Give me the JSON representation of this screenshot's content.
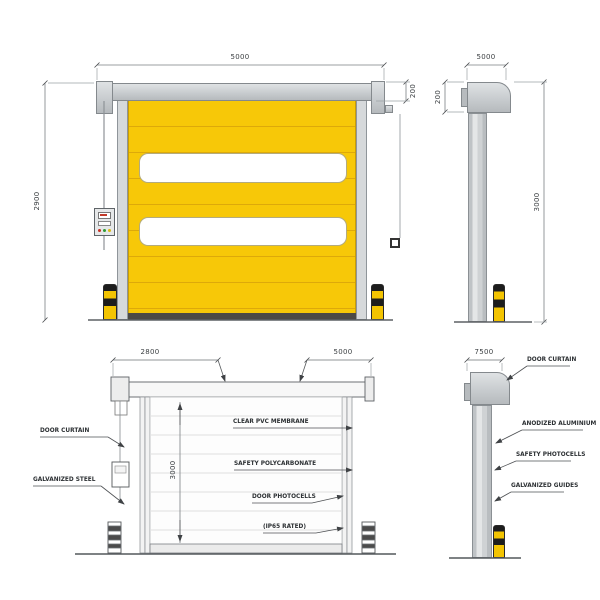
{
  "drawing": {
    "front_view": {
      "width_dim": "5000",
      "height_dim": "2900",
      "header_dim": "200"
    },
    "side_view": {
      "width_dim": "5000",
      "header_dim": "200",
      "height_dim": "3000"
    },
    "front_detail_view": {
      "curtain_width_dim": "2800",
      "total_width_dim": "5000",
      "height_dim": "3000",
      "label_door_curtain": "DOOR CURTAIN",
      "label_galvanized_steel": "GALVANIZED STEEL",
      "label_clear_pvc": "CLEAR PVC MEMBRANE",
      "label_safety_polycarbonate": "SAFETY POLYCARBONATE",
      "label_photocells": "DOOR PHOTOCELLS",
      "label_ip_rating": "(IP65 RATED)"
    },
    "side_detail_view": {
      "width_dim": "7500",
      "label_door_curtain": "DOOR CURTAIN",
      "label_anodized_aluminium": "ANODIZED ALUMINIUM",
      "label_safety_photocells": "SAFETY PHOTOCELLS",
      "label_galvanized_guides": "GALVANIZED GUIDES"
    },
    "colors": {
      "curtain_yellow": "#F7C600",
      "frame_gray": "#C9CCCE",
      "bollard_black": "#1E1E1E",
      "line_gray": "#5B6065"
    }
  }
}
